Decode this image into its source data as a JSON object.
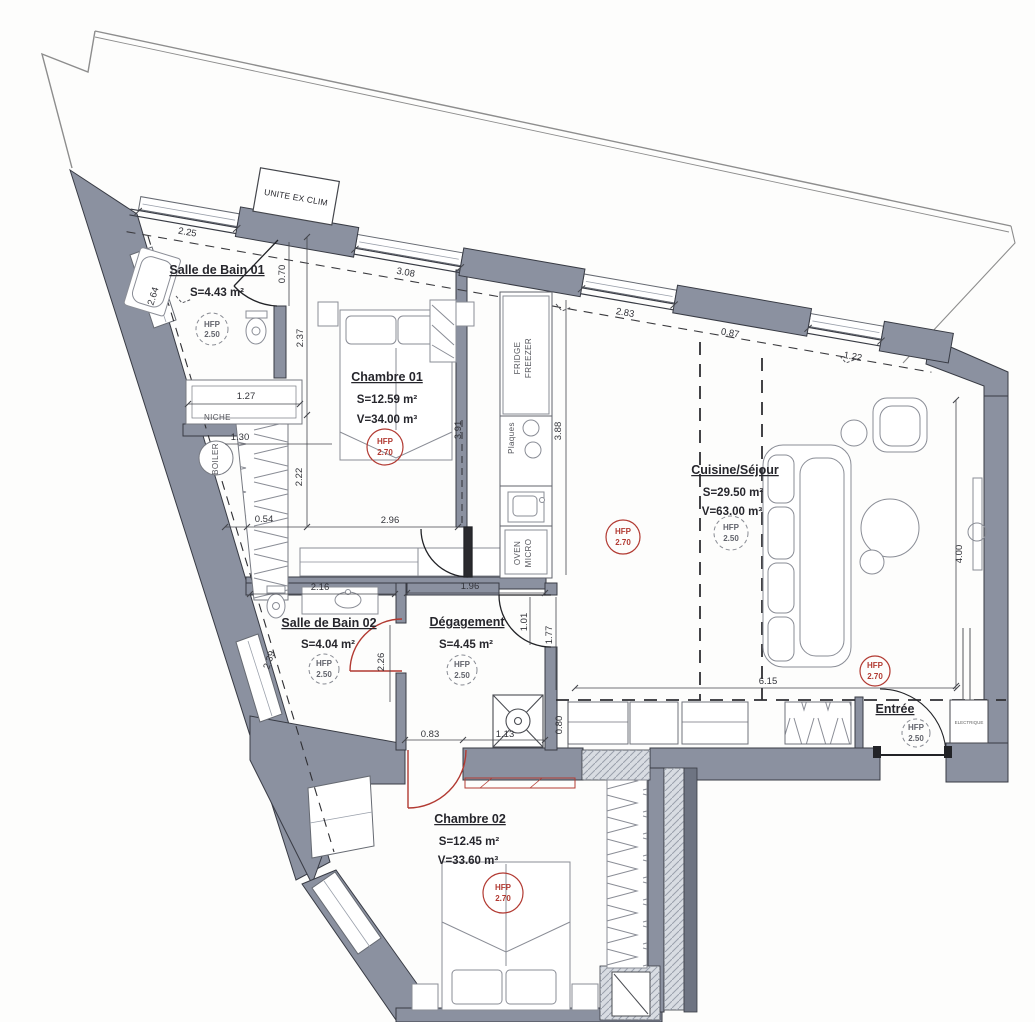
{
  "meta": {
    "title": "Plan appartement - niveau"
  },
  "colors": {
    "wall": "#8b91a0",
    "wall_dark": "#6e7482",
    "line": "#383b44",
    "red": "#b23a32",
    "hatch_bg": "#d8dce2"
  },
  "site": {
    "unite_label": "UNITE EX CLIM"
  },
  "labels": {
    "hfp": "HFP",
    "niche": "NICHE",
    "boiler": "BOILER",
    "fridge": "FRIDGE",
    "freezer": "FREEZER",
    "plaques": "Plaques",
    "oven": "OVEN",
    "micro": "MICRO",
    "electrique": "ELECTRIQUE"
  },
  "hfp_values": {
    "low": "2.50",
    "high": "2.70"
  },
  "rooms": {
    "sdb1": {
      "name": "Salle de Bain 01",
      "area": "S=4.43 m²"
    },
    "ch1": {
      "name": "Chambre 01",
      "area": "S=12.59 m²",
      "volume": "V=34.00 m³"
    },
    "cuisine": {
      "name": "Cuisine/Séjour",
      "area": "S=29.50 m²",
      "volume": "V=63.00 m³"
    },
    "sdb2": {
      "name": "Salle de Bain 02",
      "area": "S=4.04 m²"
    },
    "deg": {
      "name": "Dégagement",
      "area": "S=4.45 m²"
    },
    "entree": {
      "name": "Entrée"
    },
    "ch2": {
      "name": "Chambre 02",
      "area": "S=12.45 m²",
      "volume": "V=33.60 m³"
    }
  },
  "dims": {
    "top_sdb1": "2.25",
    "top_ch1": "3.08",
    "top_kitchen": "2.83",
    "top_block": "0.87",
    "top_right": "1.22",
    "left_sdb1": "2.64",
    "door_sdb1": "0.70",
    "wall_sdb1": "2.37",
    "niche_w": "1.27",
    "boiler_w": "1.30",
    "closet_w": "0.54",
    "ch1_h": "2.22",
    "ch1_w": "2.96",
    "kitchen_l": "3.91",
    "kitchen_r": "3.88",
    "right_wall": "4.00",
    "sdb2_w": "2.16",
    "deg_w": "1.96",
    "deg_door": "1.01",
    "sdb2_door": "2.26",
    "sdb2_diag": "2.39",
    "cuisine_h": "1.77",
    "cuisine_w": "6.15",
    "bottom_h": "0.80",
    "deg_b1": "0.83",
    "deg_b2": "1.13"
  }
}
